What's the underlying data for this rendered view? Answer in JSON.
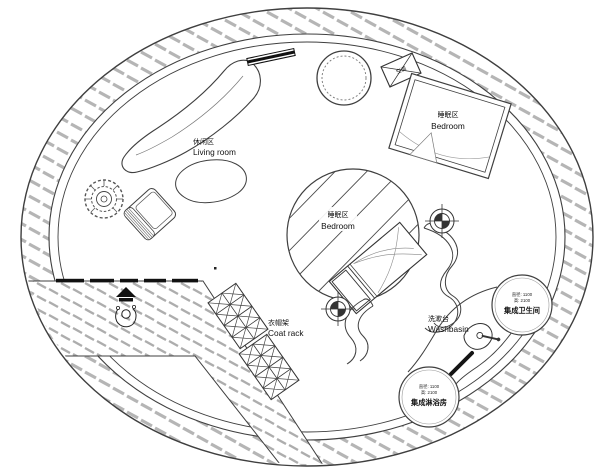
{
  "plan": {
    "colors": {
      "line": "#3f3f3f",
      "hatch": "#b5b5b5",
      "background": "#ffffff"
    },
    "labels": {
      "living_zh": "休闲区",
      "living_en": "Living room",
      "bedroom1_zh": "睡眠区",
      "bedroom1_en": "Bedroom",
      "bedroom2_zh": "睡眠区",
      "bedroom2_en": "Bedroom",
      "coatrack_zh": "衣帽架",
      "coatrack_en": "Coat rack",
      "washbasin_zh": "洗漱台",
      "washbasin_en": "Washbasin",
      "bathroom_dim1": "直径: 1100",
      "bathroom_dim2": "高: 2100",
      "bathroom_name": "集成卫生间",
      "shower_dim1": "直径: 1100",
      "shower_dim2": "高: 2100",
      "shower_name": "集成淋浴房",
      "ac_label": "空调"
    },
    "symbols": [
      "outer-hatched-wall-ring",
      "entry-deck-hatch",
      "sliding-door-line",
      "person-figure",
      "curved-sofa",
      "coffee-table",
      "potted-plant",
      "armchair",
      "wall-mounted-panel",
      "round-table",
      "air-conditioner",
      "double-bed",
      "platform-bed",
      "privacy-screen-waves",
      "downlight-target",
      "coat-rack",
      "washbasin-sink",
      "direction-arrow",
      "bathroom-pod-circle",
      "shower-pod-circle"
    ]
  }
}
